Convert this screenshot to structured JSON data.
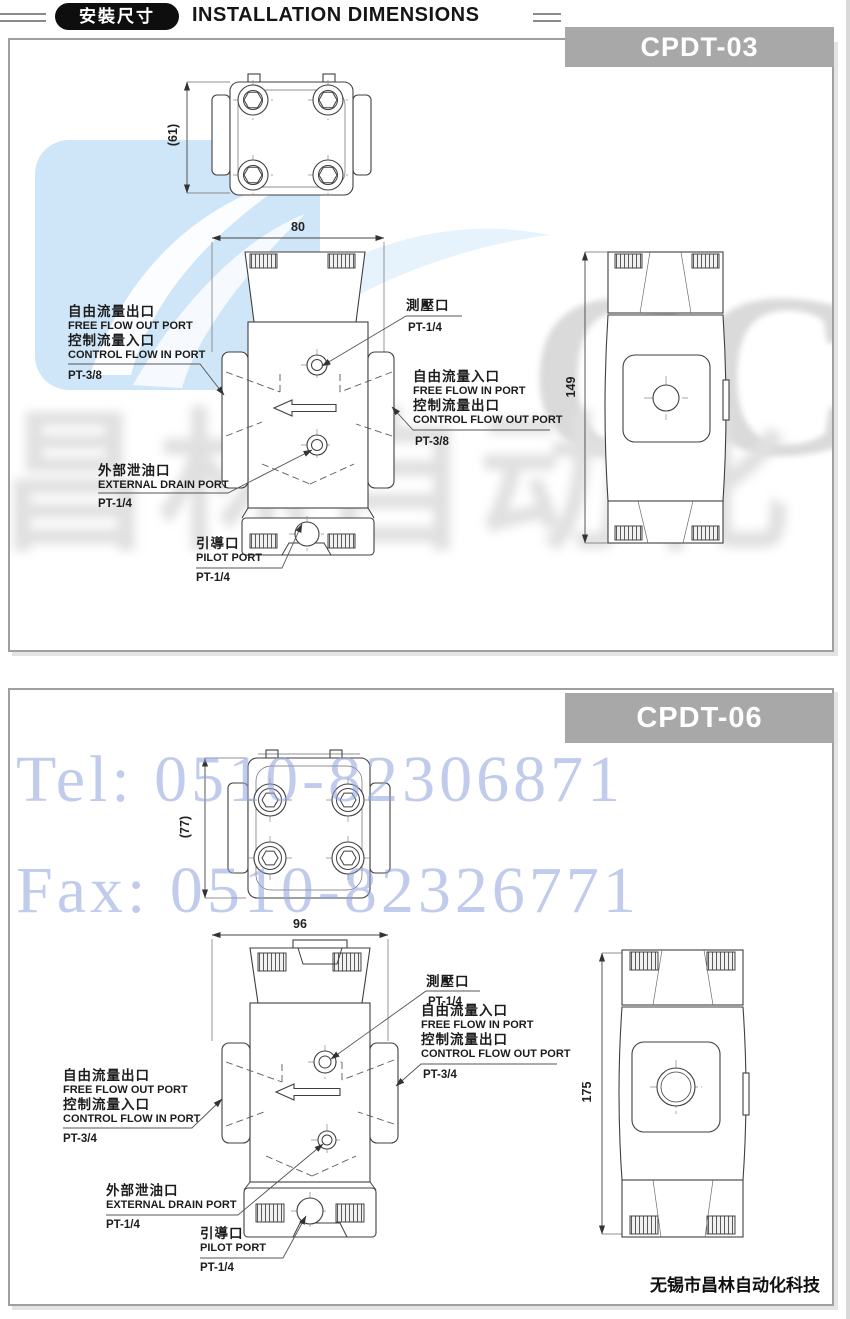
{
  "header": {
    "badge": "安裝尺寸",
    "title": "INSTALLATION DIMENSIONS"
  },
  "watermark": {
    "brand": "CCLair",
    "brand_cn": "昌林自动化",
    "tel": "Tel: 0510-82306871",
    "fax": "Fax: 0510-82326771"
  },
  "footer": {
    "company": "无锡市昌林自动化科技"
  },
  "colors": {
    "model_tag_bg": "#a8a8a8",
    "badge_bg": "#0e0e0e",
    "watermark_logo_blue": "#cfe6f8",
    "watermark_telfax_blue": "#8fa3dd",
    "line_ink": "#3f3f3f"
  },
  "sections": [
    {
      "model": "CPDT-03",
      "dims": {
        "height_top": "(61)",
        "width": "80",
        "height": "149"
      },
      "labels": {
        "free_out_cn": "自由流量出口",
        "free_out_en": "FREE FLOW OUT PORT",
        "control_in_cn": "控制流量入口",
        "control_in_en": "CONTROL FLOW IN PORT",
        "left_pt": "PT-3/8",
        "gauge_cn": "測壓口",
        "gauge_pt": "PT-1/4",
        "free_in_cn": "自由流量入口",
        "free_in_en": "FREE FLOW IN PORT",
        "control_out_cn": "控制流量出口",
        "control_out_en": "CONTROL FLOW OUT PORT",
        "right_pt": "PT-3/8",
        "drain_cn": "外部泄油口",
        "drain_en": "EXTERNAL DRAIN PORT",
        "drain_pt": "PT-1/4",
        "pilot_cn": "引導口",
        "pilot_en": "PILOT PORT",
        "pilot_pt": "PT-1/4"
      }
    },
    {
      "model": "CPDT-06",
      "dims": {
        "height_top": "(77)",
        "width": "96",
        "height": "175"
      },
      "labels": {
        "free_out_cn": "自由流量出口",
        "free_out_en": "FREE FLOW OUT PORT",
        "control_in_cn": "控制流量入口",
        "control_in_en": "CONTROL FLOW IN PORT",
        "left_pt": "PT-3/4",
        "gauge_cn": "測壓口",
        "gauge_pt": "PT-1/4",
        "free_in_cn": "自由流量入口",
        "free_in_en": "FREE FLOW IN PORT",
        "control_out_cn": "控制流量出口",
        "control_out_en": "CONTROL FLOW OUT PORT",
        "right_pt": "PT-3/4",
        "drain_cn": "外部泄油口",
        "drain_en": "EXTERNAL DRAIN PORT",
        "drain_pt": "PT-1/4",
        "pilot_cn": "引導口",
        "pilot_en": "PILOT PORT",
        "pilot_pt": "PT-1/4"
      }
    }
  ]
}
